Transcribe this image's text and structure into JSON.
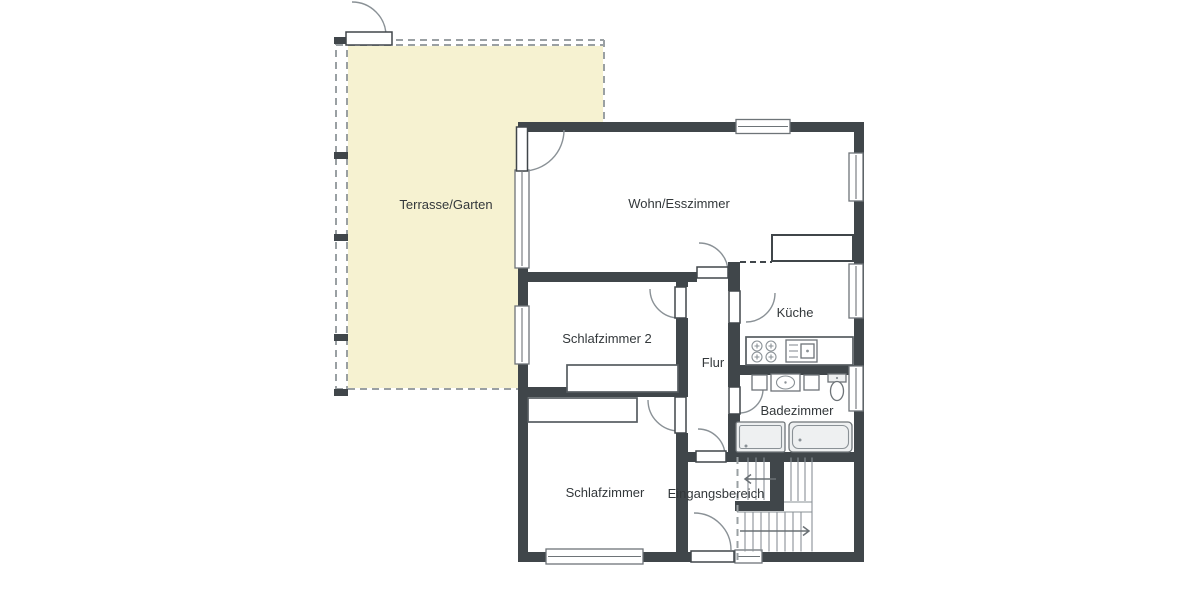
{
  "rooms": [
    {
      "label": "Terrasse/Garten"
    },
    {
      "label": "Wohn/Esszimmer"
    },
    {
      "label": "Schlafzimmer 2"
    },
    {
      "label": "Flur"
    },
    {
      "label": "Küche"
    },
    {
      "label": "Badezimmer"
    },
    {
      "label": "Schlafzimmer"
    },
    {
      "label": "Eingangsbereich"
    }
  ],
  "colors": {
    "wall": "#40464a",
    "frame": "#6e7478",
    "line": "#8a9196",
    "text": "#33383b",
    "terraceFill": "#f6f2d1",
    "terraceBorder": "#9aa0a3",
    "fixtureFill": "#eef0f1"
  }
}
